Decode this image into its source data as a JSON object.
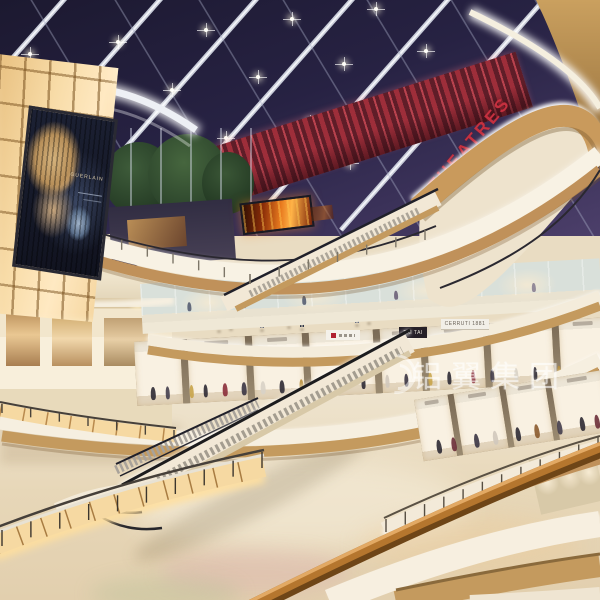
{
  "scene": {
    "title": "Multi-level shopping mall atrium interior rendering",
    "watermark": {
      "text": "铝翼集团"
    },
    "signs": {
      "theatres": "THEATRES",
      "tai_tai": "TAI TAI",
      "cerruti": "CERRUTI 1881",
      "billboard_brand": "GUERLAIN"
    },
    "palette": {
      "ceiling_navy": "#252138",
      "beam_white": "#dfe2ec",
      "red_sign": "#c5303f",
      "red_wall": "#9e2e3a",
      "amber_panel": "#f8dca8",
      "wood": "#b9894e",
      "cream": "#f4ecdb",
      "floor": "#e9dcc2",
      "fire_screen": "#e87a1e"
    }
  },
  "skylight": {
    "lights": [
      [
        30,
        54
      ],
      [
        118,
        42
      ],
      [
        206,
        30
      ],
      [
        292,
        19
      ],
      [
        376,
        9
      ],
      [
        86,
        102
      ],
      [
        172,
        90
      ],
      [
        258,
        77
      ],
      [
        344,
        64
      ],
      [
        426,
        51
      ],
      [
        140,
        153
      ],
      [
        226,
        138
      ],
      [
        310,
        122
      ],
      [
        390,
        106
      ],
      [
        268,
        181
      ],
      [
        350,
        163
      ]
    ]
  },
  "people": [
    [
      219,
      331,
      13,
      "#d9d3e1",
      "#6b7389",
      3
    ],
    [
      231,
      329,
      13,
      "#8b95b9",
      "#3d4559",
      3
    ],
    [
      262,
      330,
      13,
      "#c97f8e",
      "#4a5268",
      3
    ],
    [
      289,
      327,
      13,
      "#f2f0ec",
      "#5a6478",
      3
    ],
    [
      302,
      329,
      13,
      "#5a6a8e",
      "#2e3648",
      3
    ],
    [
      357,
      325,
      12,
      "#d0c8ba",
      "#6a7288",
      3
    ],
    [
      369,
      323,
      12,
      "#9a6a7e",
      "#3a4256",
      3
    ],
    [
      567,
      118,
      10,
      "#c8c4d0",
      "#4a4458",
      5
    ],
    [
      576,
      115,
      10,
      "#8a8498",
      "#3a3448",
      5
    ],
    [
      300,
      269,
      12,
      "#b0485a",
      "#3c4458",
      5
    ],
    [
      344,
      246,
      12,
      "#d8d2c6",
      "#5a6478",
      5
    ],
    [
      371,
      232,
      12,
      "#5a6a92",
      "#2e3648",
      5
    ],
    [
      41,
      394,
      16,
      "#c94f5e",
      "#e0dacc",
      3
    ],
    [
      57,
      391,
      16,
      "#f4f2ee",
      "#6a7488",
      3
    ],
    [
      73,
      395,
      16,
      "#7a86c8",
      "#e8e6f0",
      3
    ],
    [
      102,
      388,
      15,
      "#d8cfc0",
      "#4a5468",
      3
    ],
    [
      137,
      444,
      17,
      "#b9aed6",
      "#e8e4f0",
      3
    ],
    [
      150,
      441,
      17,
      "#8fb4d8",
      "#f4f2ee",
      3
    ],
    [
      162,
      446,
      17,
      "#e8b5c2",
      "#d8d0e8",
      3
    ],
    [
      172,
      442,
      17,
      "#f2f0ec",
      "#9aa4b8",
      3
    ],
    [
      234,
      434,
      16,
      "#c0485e",
      "#e8e0d0",
      7
    ],
    [
      409,
      425,
      17,
      "#d0c8ba",
      "#5a6478",
      3
    ],
    [
      421,
      422,
      17,
      "#3e4a66",
      "#8a94a8",
      3
    ],
    [
      465,
      412,
      17,
      "#c8bfae",
      "#7a5a3e",
      3
    ],
    [
      536,
      403,
      18,
      "#c0455a",
      "#8a6a4e",
      3
    ],
    [
      548,
      401,
      18,
      "#d8d2c8",
      "#8898b0",
      3
    ],
    [
      471,
      481,
      21,
      "#b0455a",
      "#e6dfd2",
      7
    ],
    [
      483,
      478,
      21,
      "#4a3f66",
      "#8890a4",
      7
    ],
    [
      509,
      471,
      20,
      "#7ec3dd",
      "#c9bfae",
      7
    ],
    [
      522,
      469,
      20,
      "#32395a",
      "#4a5368",
      7
    ],
    [
      538,
      465,
      20,
      "#3f4a62",
      "#8a94a8",
      7
    ],
    [
      557,
      459,
      19,
      "#c7cdd8",
      "#4e586e",
      7
    ],
    [
      569,
      456,
      19,
      "#88704e",
      "#3e4658",
      7
    ],
    [
      23,
      514,
      19,
      "#b8a0c8",
      "#5a6278",
      7
    ],
    [
      35,
      510,
      19,
      "#8898b0",
      "#3a4458",
      7
    ],
    [
      90,
      568,
      26,
      "#b23b4a",
      "#2f3550",
      9
    ],
    [
      104,
      564,
      26,
      "#3c4f77",
      "#262b3a",
      9
    ],
    [
      197,
      532,
      24,
      "#7b5ea7",
      "#d8d3e8",
      9
    ],
    [
      210,
      529,
      24,
      "#e8e4ee",
      "#8a7fb0",
      9
    ],
    [
      248,
      531,
      24,
      "#444d66",
      "#f2f0ec",
      9
    ],
    [
      274,
      527,
      23,
      "#f4f2ee",
      "#3a4660",
      9
    ],
    [
      286,
      524,
      23,
      "#6b7488",
      "#2e3546",
      9
    ],
    [
      298,
      525,
      23,
      "#d77f9a",
      "#f2f0ec",
      9
    ],
    [
      372,
      558,
      27,
      "#c35a74",
      "#e8e2d4",
      9
    ],
    [
      407,
      553,
      27,
      "#4a6c52",
      "#cbbfa4",
      9
    ],
    [
      456,
      501,
      21,
      "#33415e",
      "#6c7b96",
      7
    ],
    [
      468,
      497,
      21,
      "#8a93a8",
      "#3a4254",
      7
    ],
    [
      480,
      501,
      21,
      "#b8c0d0",
      "#5b6478",
      7
    ],
    [
      492,
      497,
      21,
      "#2e3950",
      "#8d96aa",
      7
    ],
    [
      503,
      500,
      21,
      "#5964a8",
      "#3b4258",
      7
    ],
    [
      447,
      548,
      28,
      "#d8cfc2",
      "#7a8aa0",
      9
    ],
    [
      508,
      548,
      25,
      "#7ec3dd",
      "#c9bfae",
      9
    ],
    [
      523,
      551,
      25,
      "#323950",
      "#4a5368",
      9
    ],
    [
      539,
      547,
      25,
      "#3f4a62",
      "#2c3344",
      9
    ],
    [
      567,
      488,
      20,
      "#c7cdd8",
      "#4e586e",
      9
    ],
    [
      579,
      491,
      20,
      "#88704e",
      "#3e4658",
      9
    ]
  ],
  "storefronts": {
    "upper_row_figures": [
      [
        10,
        "#555d72"
      ],
      [
        22,
        "#8a7f92"
      ],
      [
        35,
        "#555d72"
      ],
      [
        55,
        "#6a6078"
      ],
      [
        70,
        "#555d72"
      ],
      [
        85,
        "#8a7f92"
      ]
    ],
    "middle_row_figures": [
      [
        3,
        "#2e2a34"
      ],
      [
        6,
        "#443e4c"
      ],
      [
        11,
        "#c8a44a"
      ],
      [
        14,
        "#2e2a34"
      ],
      [
        18,
        "#8a2d3a"
      ],
      [
        22,
        "#3a3442"
      ],
      [
        26,
        "#d8d2c6"
      ],
      [
        30,
        "#2e2a34"
      ],
      [
        34,
        "#b8903e"
      ],
      [
        38,
        "#47404e"
      ],
      [
        43,
        "#8a2d3a"
      ],
      [
        47,
        "#2e2a34"
      ],
      [
        52,
        "#d0c8bc"
      ],
      [
        56,
        "#3a3442"
      ],
      [
        61,
        "#c8a44a"
      ],
      [
        65,
        "#2e2a34"
      ],
      [
        70,
        "#8a2d3a"
      ],
      [
        74,
        "#443e4c"
      ],
      [
        79,
        "#d8d2c6"
      ],
      [
        83,
        "#2e2a34"
      ],
      [
        88,
        "#b8903e"
      ],
      [
        92,
        "#3a3442"
      ],
      [
        96,
        "#8a2d3a"
      ]
    ],
    "right_row_figures": [
      [
        8,
        "#2e2a34"
      ],
      [
        16,
        "#6a2d38"
      ],
      [
        28,
        "#3a3442"
      ],
      [
        38,
        "#d0c8bc"
      ],
      [
        50,
        "#2e2a34"
      ],
      [
        60,
        "#8a5a2e"
      ],
      [
        72,
        "#443e4c"
      ],
      [
        84,
        "#2e2a34"
      ],
      [
        92,
        "#6a2d38"
      ]
    ]
  }
}
